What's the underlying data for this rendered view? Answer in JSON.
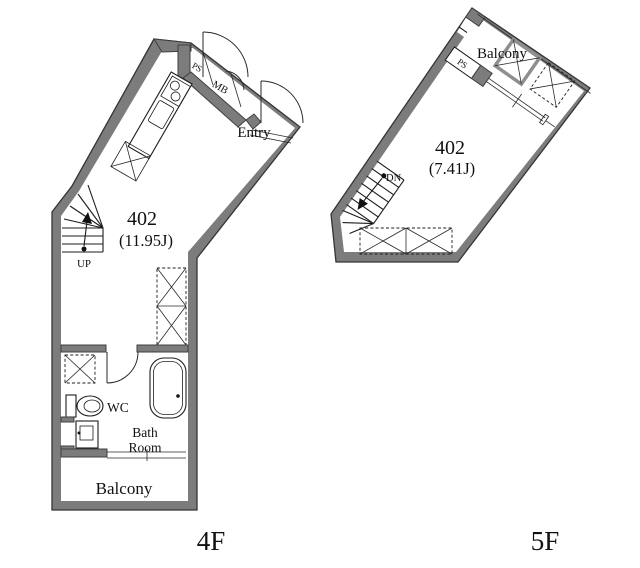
{
  "doc": {
    "type": "apartment-floor-plan",
    "colors": {
      "wall": "#7c7c7c",
      "line": "#1c1c1c",
      "background": "#ffffff"
    }
  },
  "floor4": {
    "floor_label": "4F",
    "unit": "402",
    "area": "(11.95J)",
    "labels": {
      "ps": "PS",
      "mb": "MB",
      "entry": "Entry",
      "up": "UP",
      "wc": "WC",
      "bath_line1": "Bath",
      "bath_line2": "Room",
      "balcony": "Balcony"
    }
  },
  "floor5": {
    "floor_label": "5F",
    "unit": "402",
    "area": "(7.41J)",
    "labels": {
      "balcony": "Balcony",
      "ps": "PS",
      "dn": "DN"
    }
  }
}
